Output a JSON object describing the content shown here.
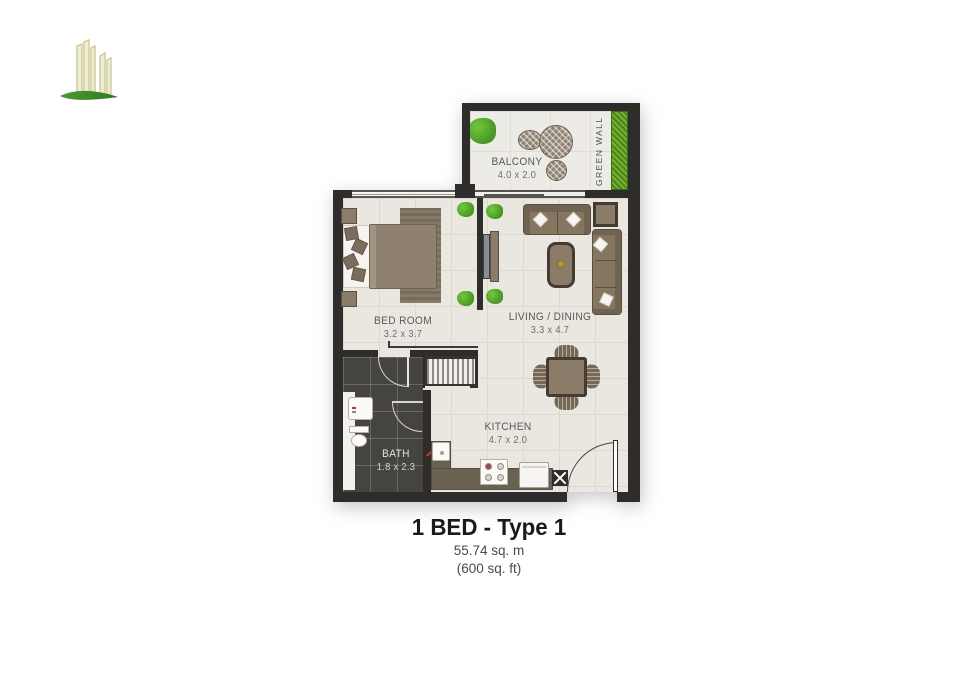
{
  "logo": {
    "name": "green-towers-logo"
  },
  "floorplan": {
    "rooms": {
      "balcony": {
        "name": "BALCONY",
        "dimensions": "4.0 x 2.0"
      },
      "bedroom": {
        "name": "BED ROOM",
        "dimensions": "3.2 x 3.7"
      },
      "living_dining": {
        "name": "LIVING / DINING",
        "dimensions": "3.3 x 4.7"
      },
      "kitchen": {
        "name": "KITCHEN",
        "dimensions": "4.7 x 2.0"
      },
      "bath": {
        "name": "BATH",
        "dimensions": "1.8 x 2.3"
      }
    },
    "features": {
      "green_wall": "GREEN WALL"
    }
  },
  "caption": {
    "title": "1 BED - Type 1",
    "area_metric": "55.74 sq. m",
    "area_imperial": "(600 sq. ft)"
  },
  "colors": {
    "wall": "#2f2d2b",
    "floor": "#eae7e1",
    "bath_floor": "#46443f",
    "furniture": "#8a7c69",
    "plant_green": "#55b32b",
    "green_wall": "#5a9422",
    "label_text": "#595959"
  }
}
